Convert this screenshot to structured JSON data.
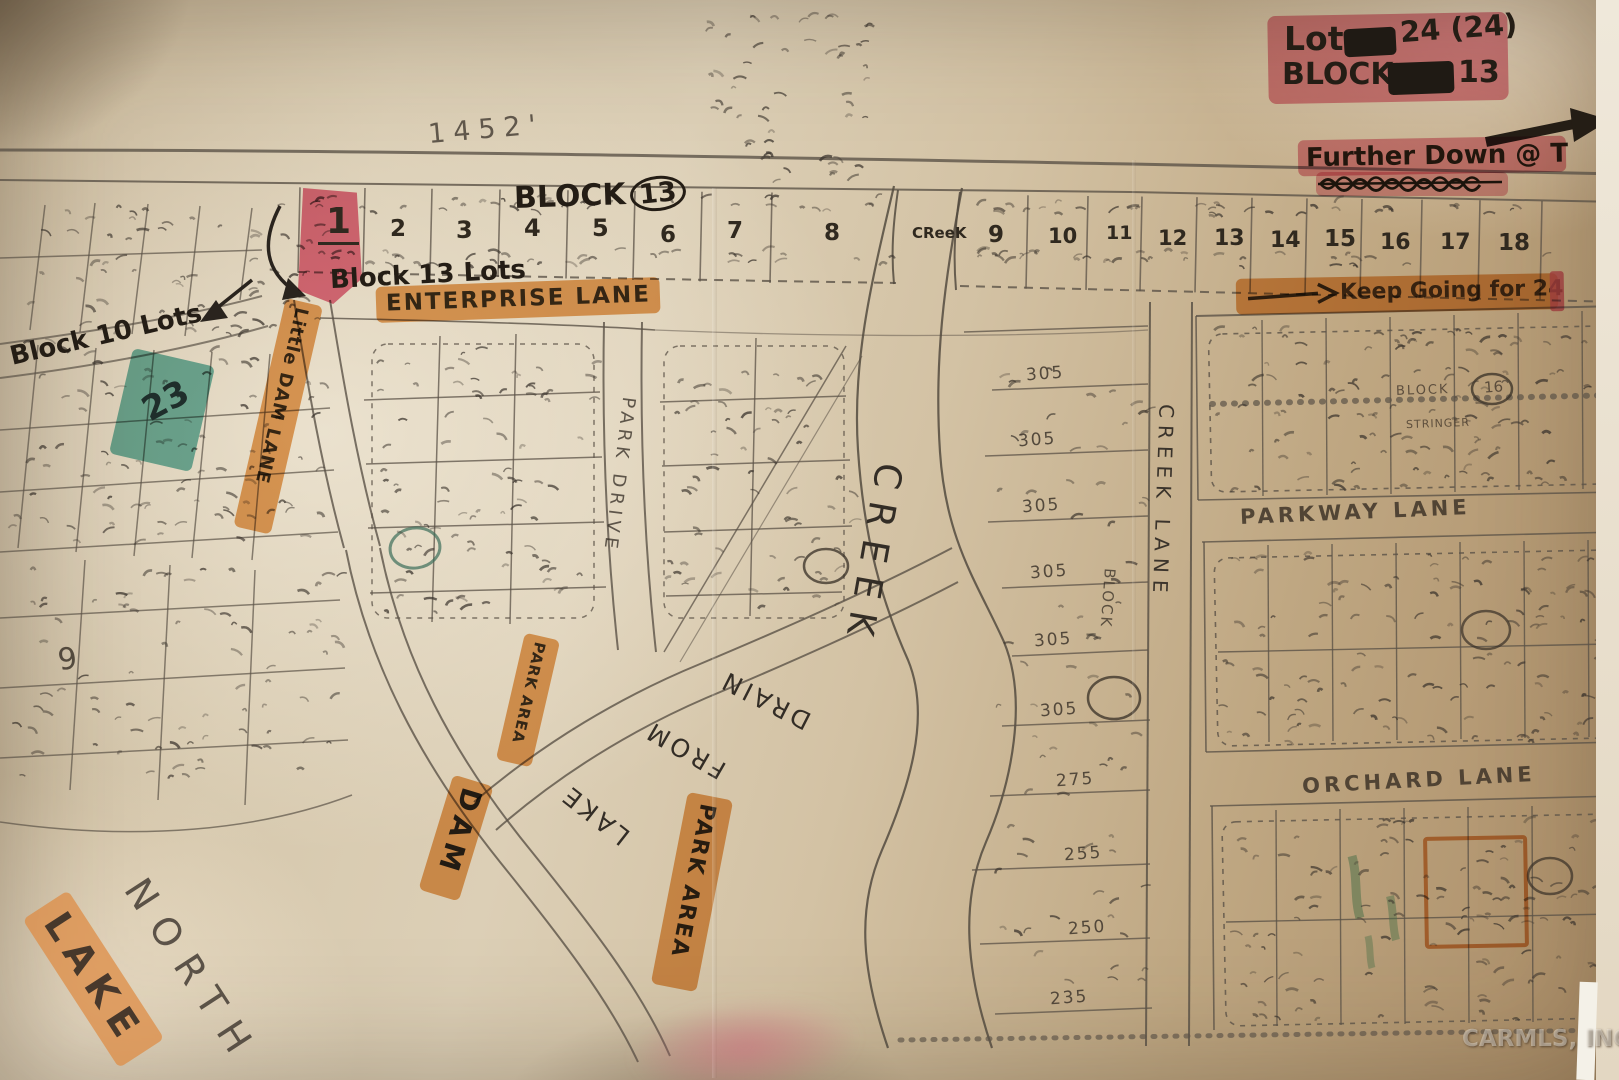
{
  "legend": {
    "lot_label": "Lot",
    "lot_value": "24 (24)",
    "block_label": "BLOCK",
    "block_value": "13",
    "further_down": "Further Down @ T",
    "keep_going": "Keep Going for 24"
  },
  "top_row": {
    "block_heading": "BLOCK",
    "block_heading_number": "13",
    "lots": [
      "1",
      "2",
      "3",
      "4",
      "5",
      "6",
      "7",
      "8",
      "9",
      "10",
      "11",
      "12",
      "13",
      "14",
      "15",
      "16",
      "17",
      "18"
    ],
    "creek_label": "CReeK"
  },
  "annotations": {
    "block13_lots": "Block 13 Lots",
    "block10_lots": "Block 10 Lots",
    "lot23": "23",
    "measurement": "1452'",
    "left_lot_number": "9"
  },
  "streets": {
    "enterprise": "ENTERPRISE LANE",
    "little_dam": "Little DAM LANE",
    "park_drive": "PARK DRIVE",
    "creek": "CREEK",
    "creek_lane": "CREEK LANE",
    "parkway": "PARKWAY LANE",
    "orchard": "ORCHARD LANE",
    "drain_word1": "DRAIN",
    "drain_word2": "FROM",
    "drain_word3": "LAKE",
    "dam": "DAM",
    "park_area": "PARK AREA",
    "north": "NORTH",
    "lake": "LAKE"
  },
  "blocks": {
    "vertical_block_label": "BLOCK",
    "right_block_label": "BLOCK",
    "right_block_number": "16",
    "stringer": "STRINGER"
  },
  "dims": [
    "305",
    "305",
    "305",
    "305",
    "305",
    "305",
    "275",
    "255",
    "250",
    "235"
  ],
  "watermark": "CARMLS, INC",
  "colors": {
    "pink": "#e2839b",
    "orange": "#e5995a",
    "teal": "#55afa3",
    "ink": "#262019",
    "pencil": "#4a4238"
  }
}
